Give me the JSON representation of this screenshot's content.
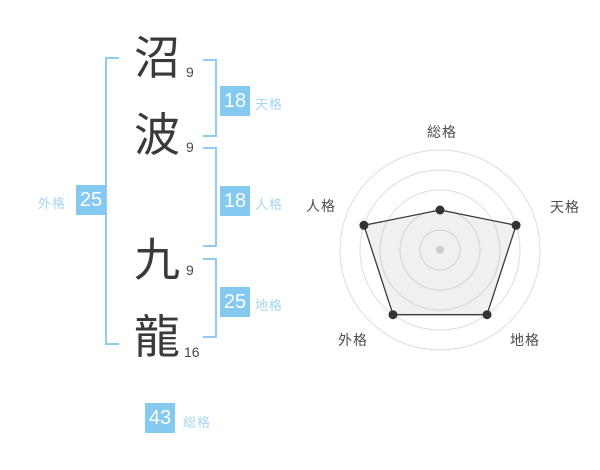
{
  "name": {
    "chars": [
      {
        "char": "沼",
        "strokes": "9"
      },
      {
        "char": "波",
        "strokes": "9"
      },
      {
        "char": "九",
        "strokes": "9"
      },
      {
        "char": "龍",
        "strokes": "16"
      }
    ]
  },
  "gokaku": {
    "tenkaku": {
      "label": "天格",
      "value": "18"
    },
    "jinkaku": {
      "label": "人格",
      "value": "18"
    },
    "chikaku": {
      "label": "地格",
      "value": "25"
    },
    "gaikaku": {
      "label": "外格",
      "value": "25"
    },
    "soukaku": {
      "label": "総格",
      "value": "43"
    }
  },
  "colors": {
    "accent_badge": "#85c9f0",
    "accent_label": "#a5d6f3",
    "accent_bracket": "#8fcbf2",
    "text_dark": "#3a3a3a",
    "chart_label": "#4d4d4d"
  },
  "chart_data": {
    "type": "radar",
    "categories": [
      "総格",
      "天格",
      "地格",
      "外格",
      "人格"
    ],
    "values": [
      2,
      4,
      4,
      4,
      4
    ],
    "max": 5,
    "rings": 5,
    "start_angle_deg": 90,
    "direction": "clockwise",
    "grid_color": "#dddddd",
    "line_color": "#3a3a3a",
    "fill_color": "rgba(130,130,130,0.12)",
    "point_color": "#333333",
    "point_radius": 4.5,
    "center_dot_color": "#cccccc",
    "center_dot_radius": 4,
    "max_radius_px": 100
  }
}
